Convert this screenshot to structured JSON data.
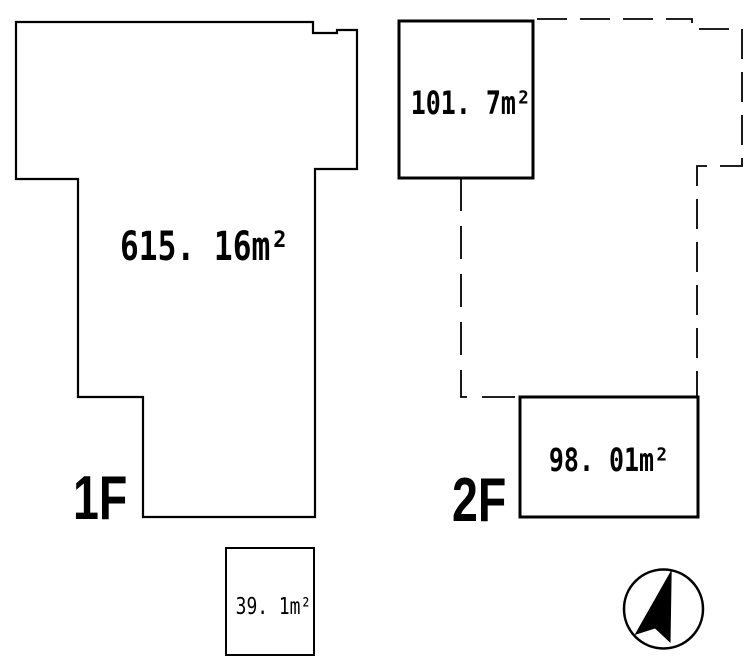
{
  "colors": {
    "background": "#ffffff",
    "ink": "#000000"
  },
  "floor1": {
    "label": "1F",
    "area": "615. 16m²",
    "annex_area": "39. 1m²"
  },
  "floor2": {
    "label": "2F",
    "upper_block_area": "101. 7m²",
    "lower_block_area": "98. 01m²"
  },
  "compass": {
    "icon": "north-arrow"
  }
}
